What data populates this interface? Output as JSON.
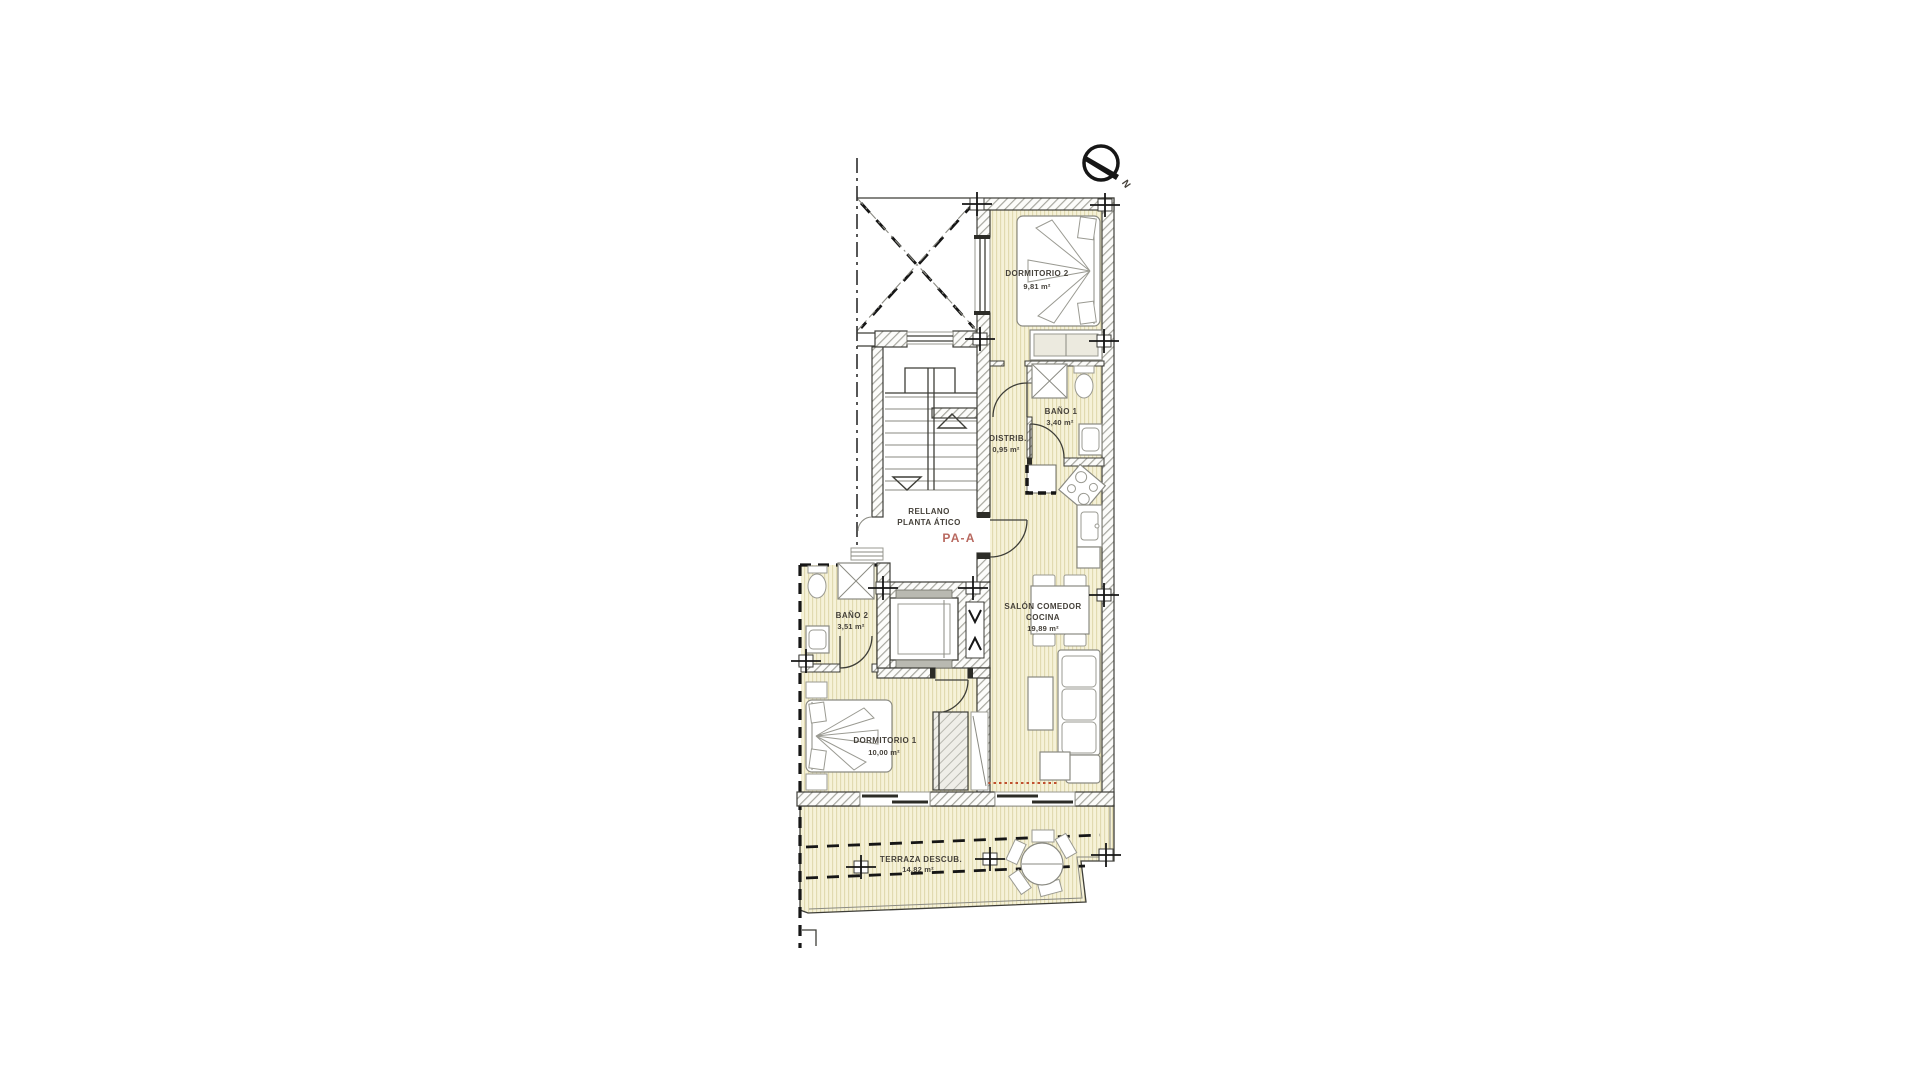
{
  "plan": {
    "compass": {
      "label": "N"
    },
    "landing": {
      "line1": "RELLANO",
      "line2": "PLANTA ÁTICO",
      "code": "PA-A"
    },
    "rooms": {
      "dormitorio2": {
        "name": "DORMITORIO 2",
        "area": "9,81 m²"
      },
      "bano1": {
        "name": "BAÑO 1",
        "area": "3,40 m²"
      },
      "distrib": {
        "name": "DISTRIB.",
        "area": "0,95 m²"
      },
      "salon": {
        "name_line1": "SALÓN COMEDOR",
        "name_line2": "COCINA",
        "area": "19,89 m²"
      },
      "bano2": {
        "name": "BAÑO 2",
        "area": "3,51 m²"
      },
      "dormitorio1": {
        "name": "DORMITORIO 1",
        "area": "10,00 m²"
      },
      "terraza": {
        "name": "TERRAZA DESCUB.",
        "area": "14,82 m²"
      }
    },
    "colors": {
      "floor": "#f6f2d8",
      "floor_stripe": "#e0d9ae",
      "wall_line": "#3e3e38",
      "hatch": "#a6a69e",
      "text": "#45413a",
      "code_accent": "#b8685f",
      "terrace_boundary_red": "#c0502e"
    }
  }
}
